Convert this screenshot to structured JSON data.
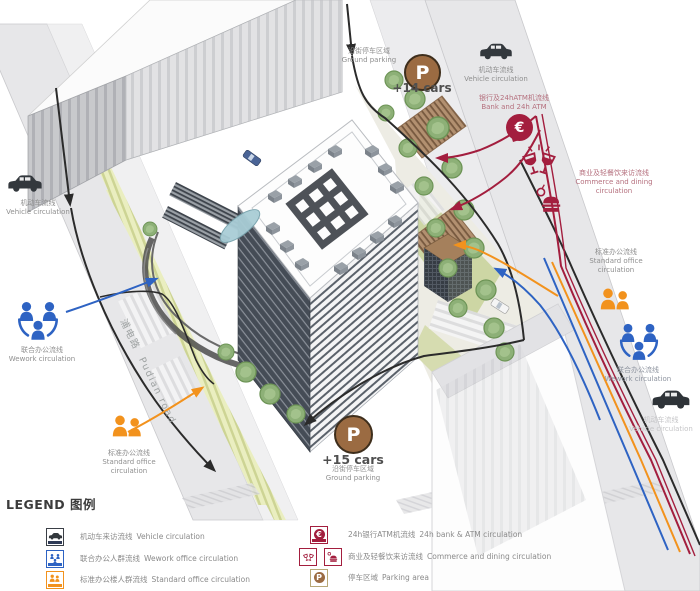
{
  "colors": {
    "vehicle": "#2b2b2b",
    "wework": "#2e63c3",
    "office": "#f2921d",
    "bank": "#a31e3e",
    "parking_fill": "#9b6b42",
    "road": "#e7e7e9",
    "grass": "#cdd6a4"
  },
  "diagram": {
    "road_label": {
      "zh": "浦电路",
      "en": "Pudian road"
    },
    "labels": {
      "parking_top": {
        "zh": "沿街停车区域",
        "en": "Ground parking",
        "count": "+14 cars"
      },
      "parking_bottom": {
        "zh": "沿街停车区域",
        "en": "Ground parking",
        "count": "+15 cars"
      },
      "vehicle_top": {
        "zh": "机动车流线",
        "en": "Vehicle circulation"
      },
      "vehicle_left": {
        "zh": "机动车流线",
        "en": "Vehicle circulation"
      },
      "vehicle_bottom": {
        "zh": "机动车流线",
        "en": "Vehicle circulation"
      },
      "bank": {
        "zh": "银行及24hATM机流线",
        "en": "Bank and 24h ATM"
      },
      "commerce": {
        "zh": "商业及轻餐饮来访流线",
        "en": "Commerce and dining circulation"
      },
      "office_left": {
        "zh": "标准办公流线",
        "en": "Standard office circulation"
      },
      "office_right": {
        "zh": "标准办公流线",
        "en": "Standard office circulation"
      },
      "wework_left": {
        "zh": "联合办公流线",
        "en": "Wework circulation"
      },
      "wework_right": {
        "zh": "联合办公流线",
        "en": "Wework circulation"
      },
      "parking_symbol": "P",
      "euro_symbol": "€"
    }
  },
  "legend": {
    "title": "LEGEND 图例",
    "items_left": [
      {
        "zh": "机动车来访流线",
        "en": "Vehicle circulation"
      },
      {
        "zh": "联合办公人群流线",
        "en": "Wework office circulation"
      },
      {
        "zh": "标准办公楼人群流线",
        "en": "Standard office circulation"
      }
    ],
    "items_right": [
      {
        "zh": "24h银行ATM机流线",
        "en": "24h bank & ATM circulation"
      },
      {
        "zh": "商业及轻餐饮来访流线",
        "en": "Commerce and dining circulation"
      },
      {
        "zh": "停车区域",
        "en": "Parking area"
      }
    ]
  }
}
